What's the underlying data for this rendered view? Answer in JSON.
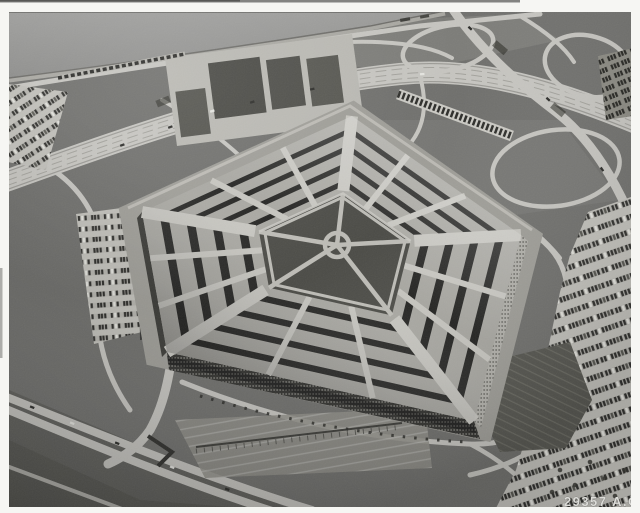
{
  "photo": {
    "id_label": "29357 A.C.",
    "subject": "Black-and-white oblique aerial photograph of the Pentagon building with surrounding highways, cloverleaf interchanges, parking lots full of cars, lagoon shoreline and grounds"
  },
  "palette": {
    "frame": "#f6f6f3",
    "scanline": "#6f6f6c",
    "water": "#949492",
    "shore": "#a8a7a1",
    "grass": "#6f6f6c",
    "grassLight": "#7c7c78",
    "grassDark": "#5e5e5a",
    "marsh": "#565651",
    "road": "#c6c5c0",
    "roadDim": "#b2b1ab",
    "terrace": "#b9b8b2",
    "lawnBlock": "#4c4c47",
    "roof": "#a7a6a0",
    "roofBright": "#c6c5bf",
    "gap": "#1f1f1d",
    "facadeDark": "#31312e",
    "facadeLight": "#b2b1ab",
    "courtyard": "#4b4b46",
    "path": "#bdbcb6",
    "apron": "#9e9d97",
    "parking": "#c1c0ba",
    "parkingRow": "#b4b3ad",
    "cars": "#2d2d2a",
    "carsLight": "#e2e2dc",
    "rail": "#8a8981",
    "garden": "#55554f",
    "dirt": "#8f8e87",
    "tree": "#34342f",
    "label": "#dcdcd8"
  }
}
